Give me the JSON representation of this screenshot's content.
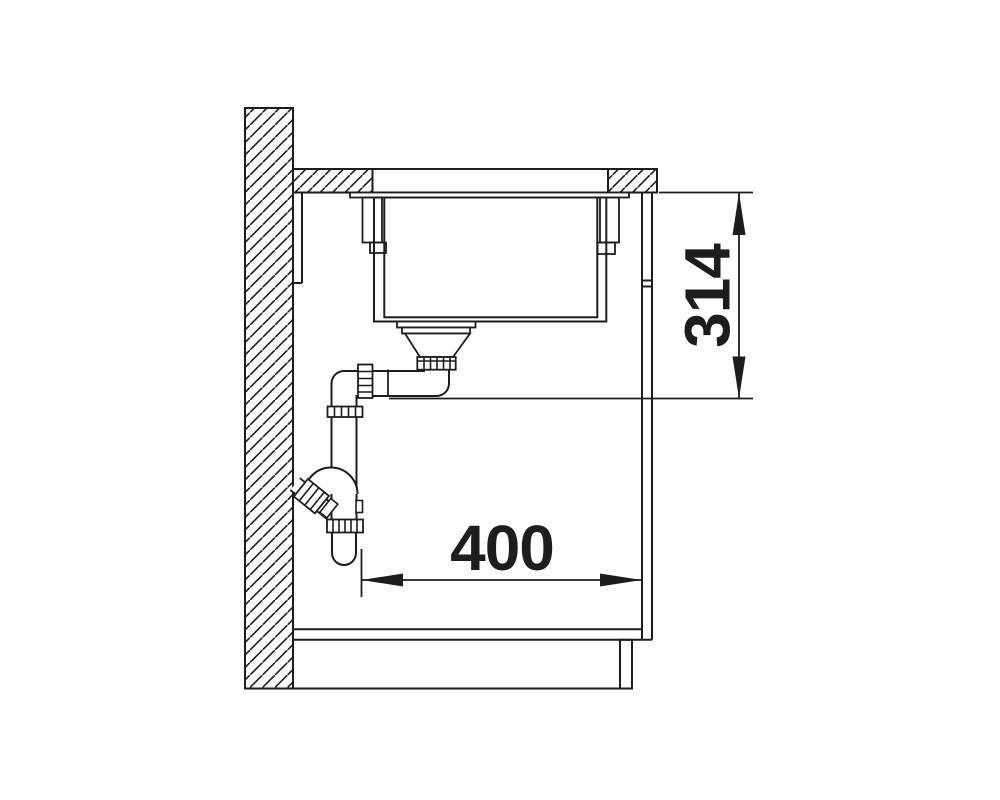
{
  "drawing": {
    "vertical_dimension": {
      "label": "314"
    },
    "horizontal_dimension": {
      "label": "400"
    },
    "colors": {
      "line": "#1d1d1b",
      "background": "#ffffff"
    }
  }
}
